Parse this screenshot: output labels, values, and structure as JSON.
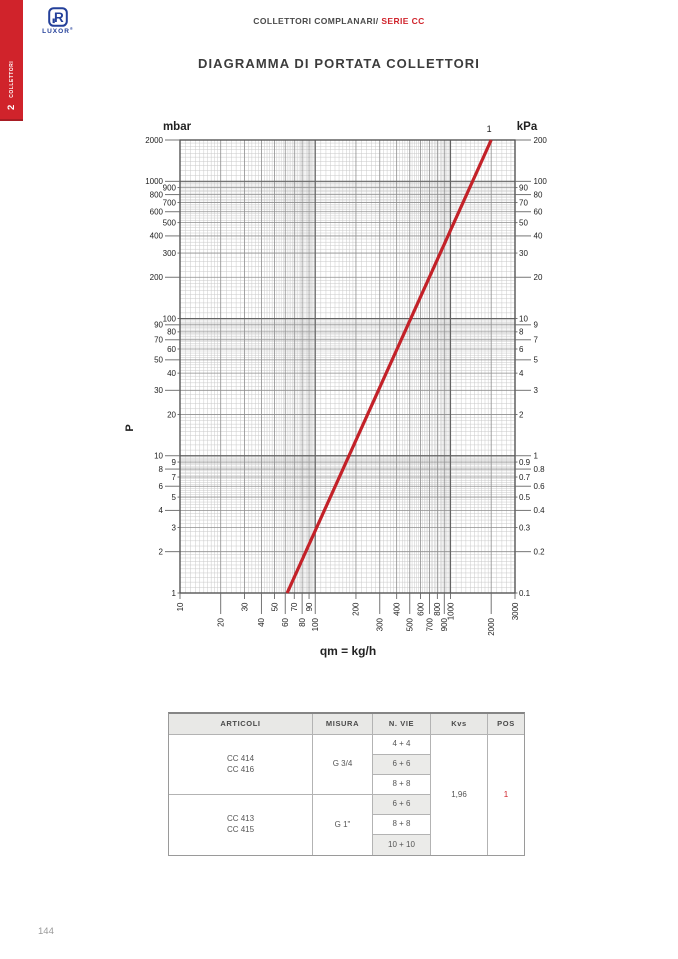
{
  "sidebar": {
    "chapter_number": "2",
    "chapter_label": "COLLETTORI"
  },
  "logo": {
    "brand": "LUXOR",
    "registered": "®"
  },
  "header": {
    "breadcrumb": "COLLETTORI COMPLANARI/",
    "series": "SERIE CC"
  },
  "page": {
    "title": "DIAGRAMMA DI PORTATA COLLETTORI",
    "number": "144"
  },
  "chart_data": {
    "type": "line",
    "title": "DIAGRAMMA DI PORTATA COLLETTORI",
    "grid": "log-log",
    "x_axis": {
      "label": "qm = kg/h",
      "scale": "log",
      "min": 10,
      "max": 3000,
      "ticks": [
        [
          10,
          0
        ],
        [
          20,
          1
        ],
        [
          30,
          0
        ],
        [
          40,
          1
        ],
        [
          50,
          0
        ],
        [
          60,
          1
        ],
        [
          70,
          0
        ],
        [
          80,
          1
        ],
        [
          90,
          0
        ],
        [
          100,
          1
        ],
        [
          200,
          0
        ],
        [
          300,
          1
        ],
        [
          400,
          0
        ],
        [
          500,
          1
        ],
        [
          600,
          0
        ],
        [
          700,
          1
        ],
        [
          800,
          0
        ],
        [
          900,
          1
        ],
        [
          1000,
          0
        ],
        [
          2000,
          1
        ],
        [
          3000,
          0
        ]
      ]
    },
    "y_axis_left": {
      "label": "mbar",
      "axis_title": "P",
      "scale": "log",
      "min": 1,
      "max": 2000,
      "ticks": [
        [
          2000,
          0
        ],
        [
          1000,
          0
        ],
        [
          900,
          1
        ],
        [
          800,
          0
        ],
        [
          700,
          1
        ],
        [
          600,
          0
        ],
        [
          500,
          1
        ],
        [
          400,
          0
        ],
        [
          300,
          1
        ],
        [
          200,
          0
        ],
        [
          100,
          1
        ],
        [
          90,
          0
        ],
        [
          80,
          1
        ],
        [
          70,
          0
        ],
        [
          60,
          1
        ],
        [
          50,
          0
        ],
        [
          40,
          1
        ],
        [
          30,
          0
        ],
        [
          20,
          1
        ],
        [
          10,
          0
        ],
        [
          9,
          1
        ],
        [
          8,
          0
        ],
        [
          7,
          1
        ],
        [
          6,
          0
        ],
        [
          5,
          1
        ],
        [
          4,
          0
        ],
        [
          3,
          1
        ],
        [
          2,
          0
        ],
        [
          1,
          1
        ]
      ]
    },
    "y_axis_right": {
      "label": "kPa",
      "scale": "log",
      "min": 0.1,
      "max": 200,
      "ticks": [
        [
          200,
          0
        ],
        [
          100,
          0
        ],
        [
          90,
          1
        ],
        [
          80,
          0
        ],
        [
          70,
          1
        ],
        [
          60,
          0
        ],
        [
          50,
          1
        ],
        [
          40,
          0
        ],
        [
          30,
          1
        ],
        [
          20,
          0
        ],
        [
          10,
          1
        ],
        [
          9,
          0
        ],
        [
          8,
          1
        ],
        [
          7,
          0
        ],
        [
          6,
          1
        ],
        [
          5,
          0
        ],
        [
          4,
          1
        ],
        [
          3,
          0
        ],
        [
          2,
          1
        ],
        [
          1,
          0
        ],
        [
          0.9,
          1
        ],
        [
          0.8,
          0
        ],
        [
          0.7,
          1
        ],
        [
          0.6,
          0
        ],
        [
          0.5,
          1
        ],
        [
          0.4,
          0
        ],
        [
          0.3,
          1
        ],
        [
          0.2,
          0
        ],
        [
          0.1,
          1
        ]
      ]
    },
    "series": [
      {
        "name": "1",
        "color": "#c32128",
        "points": [
          [
            62,
            1
          ],
          [
            2000,
            2000
          ]
        ]
      }
    ]
  },
  "table": {
    "headers": [
      "ARTICOLI",
      "MISURA",
      "N. VIE",
      "Kvs",
      "POS"
    ],
    "groups": [
      {
        "articoli": [
          "CC 414",
          "CC 416"
        ],
        "misura": "G 3/4",
        "vie": [
          "4 + 4",
          "6 + 6",
          "8 + 8"
        ]
      },
      {
        "articoli": [
          "CC 413",
          "CC 415"
        ],
        "misura": "G 1\"",
        "vie": [
          "6 + 6",
          "8 + 8",
          "10 + 10"
        ]
      }
    ],
    "kvs": "1,96",
    "pos": "1"
  },
  "colors": {
    "accent_red": "#d0232b",
    "logo_blue": "#24409a",
    "line_red": "#c32128"
  }
}
